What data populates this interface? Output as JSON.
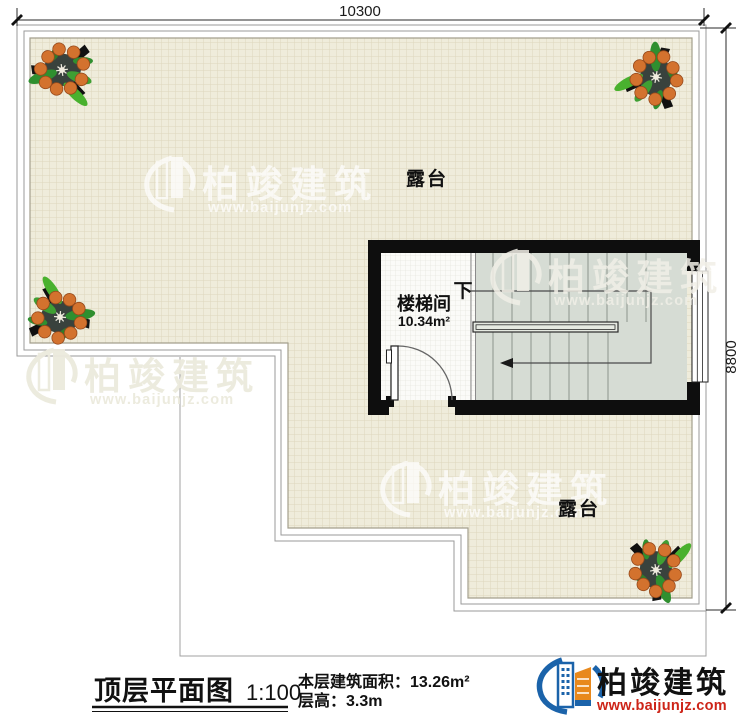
{
  "plan": {
    "dimensions": {
      "width_mm": "10300",
      "height_mm": "8800"
    },
    "rooms": {
      "terrace_upper": "露台",
      "terrace_lower": "露台",
      "stairwell": "楼梯间",
      "stairwell_area": "10.34m²",
      "stair_direction": "下"
    }
  },
  "watermark": {
    "brand": "柏竣建筑",
    "url": "www.baijunjz.com"
  },
  "title_block": {
    "title": "顶层平面图",
    "scale": "1:100",
    "floor_area": "本层建筑面积：13.26m²",
    "floor_height": "层高：3.3m"
  },
  "logo": {
    "brand": "柏竣建筑",
    "url": "www.baijunjz.com"
  },
  "colors": {
    "terrace_fill": "#efecdb",
    "terrace_grid": "#ddd6bd",
    "wall_black": "#0e0e0e",
    "stair_fill": "#d6dcd4",
    "logo_blue": "#1b63aa",
    "logo_red": "#cd2418",
    "fruit_orange": "#d3722e",
    "leaf_green": "#2f8f2f"
  }
}
